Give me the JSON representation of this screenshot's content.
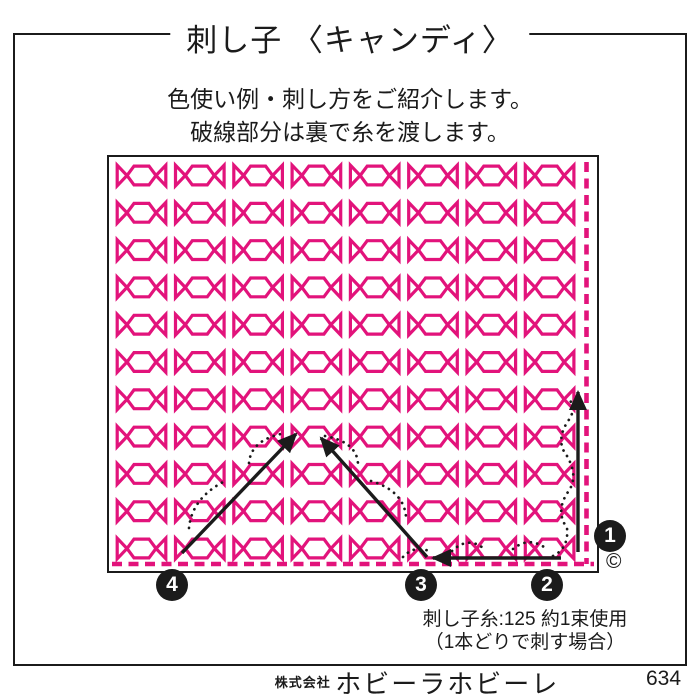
{
  "title": "刺し子 〈キャンディ〉",
  "intro": {
    "line1": "色使い例・刺し方をご紹介します。",
    "line2": "破線部分は裏で糸を渡します。"
  },
  "colors": {
    "motif_pink": "#e2137b",
    "ink_black": "#1b1b1b"
  },
  "pattern": {
    "motif": "candy",
    "rows": 11,
    "cols": 8
  },
  "steps": [
    {
      "label": "1"
    },
    {
      "label": "2"
    },
    {
      "label": "3"
    },
    {
      "label": "4"
    }
  ],
  "copyright_mark": "©",
  "thread_note": {
    "line1": "刺し子糸:125 約1束使用",
    "line2": "（1本どりで刺す場合）"
  },
  "footer": {
    "company_prefix": "株式会社",
    "company_name": "ホビーラホビーレ",
    "sheet_number": "634"
  }
}
